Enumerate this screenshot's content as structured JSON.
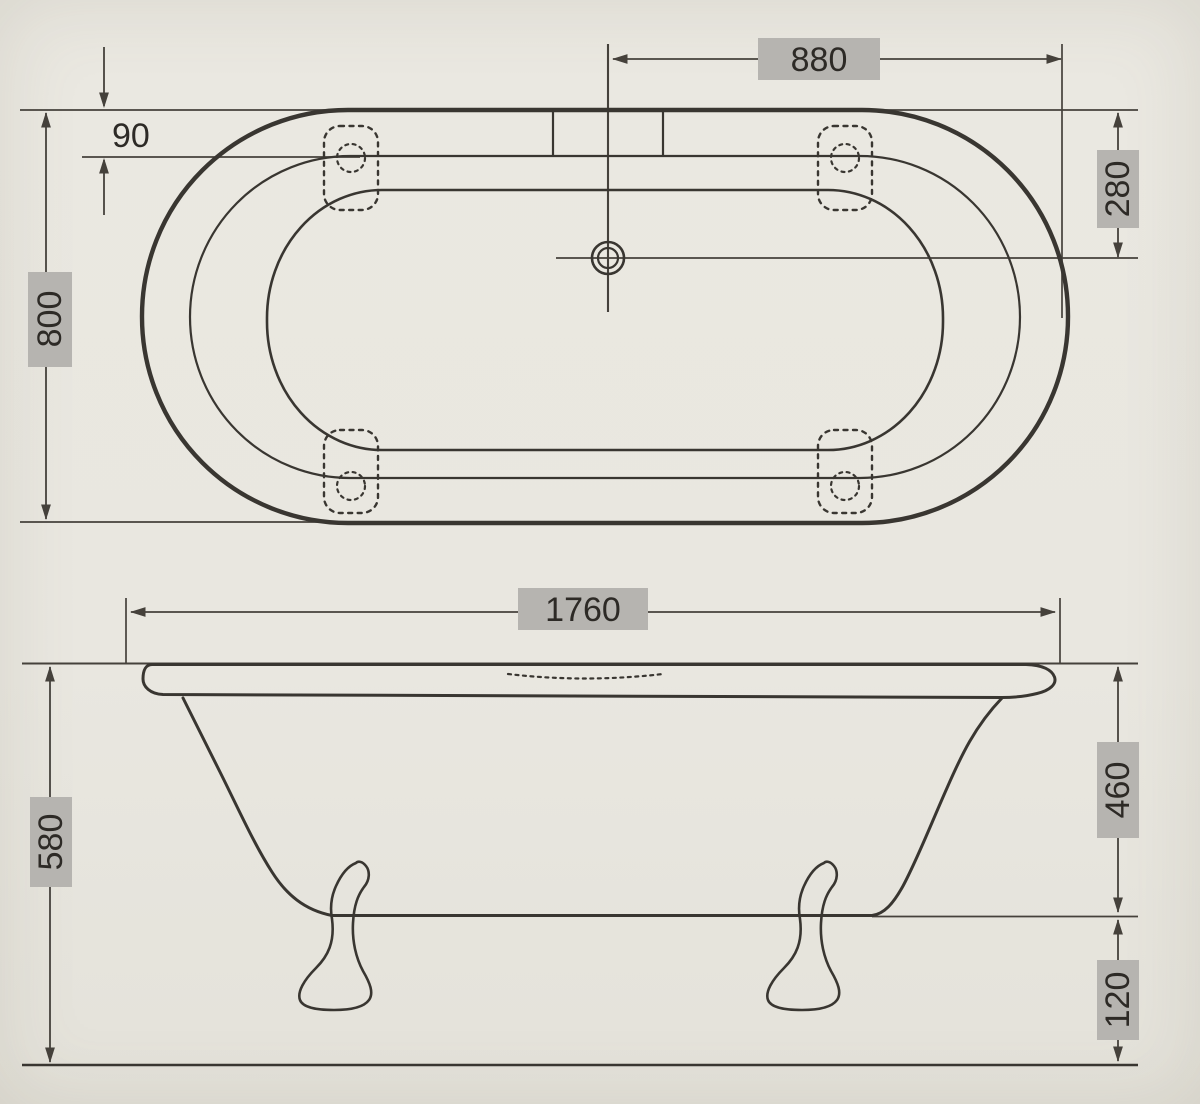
{
  "colors": {
    "paper": "#e9e7e0",
    "ink": "#393631",
    "dim": "#45413b",
    "label_bg": "#b6b4b0",
    "text": "#2d2a26"
  },
  "plan_view": {
    "dims": {
      "half_length": "880",
      "rim_offset": "90",
      "width": "800",
      "drain_offset": "280"
    }
  },
  "side_view": {
    "dims": {
      "length": "1760",
      "total_height": "580",
      "body_height": "460",
      "ground_clearance": "120"
    }
  }
}
